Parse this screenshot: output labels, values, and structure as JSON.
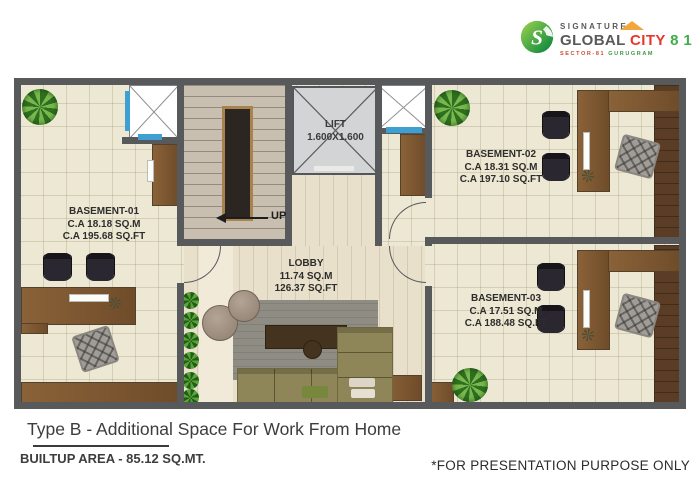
{
  "logo": {
    "signature": "SIGNATURE",
    "global": "GLOBAL ",
    "city": "CITY",
    "number": " 8 1",
    "tagline_sector": "SECTOR-81 ",
    "tagline_city": "GURUGRAM",
    "colors": {
      "gray": "#58595b",
      "red": "#e6392e",
      "green": "#3fae49",
      "orange": "#f2a63b",
      "leaf_light": "#9ed34f",
      "leaf_dark": "#00813d"
    }
  },
  "plan": {
    "rooms": {
      "basement01": {
        "name": "BASEMENT-01",
        "sqm": "C.A 18.18 SQ.M",
        "sqft": "C.A 195.68 SQ.FT"
      },
      "basement02": {
        "name": "BASEMENT-02",
        "sqm": "C.A 18.31 SQ.M",
        "sqft": "C.A 197.10 SQ.FT"
      },
      "basement03": {
        "name": "BASEMENT-03",
        "sqm": "C.A 17.51 SQ.M",
        "sqft": "C.A 188.48 SQ.FT"
      },
      "lobby": {
        "name": "LOBBY",
        "sqm": "11.74 SQ.M",
        "sqft": "126.37 SQ.FT"
      }
    },
    "lift": {
      "name": "LIFT",
      "size": "1.600X1.600"
    },
    "stairs": {
      "up_label": "UP"
    },
    "colors": {
      "wall": "#58595b",
      "floor_tile": "#ece8d4",
      "floor_wood": "#e9e0cc",
      "desk_brown": "#7d5a36",
      "lift_fill": "#d2d4d6",
      "shaft_accent_blue": "#3f9fd0",
      "sofa_olive": "#8e8558"
    }
  },
  "footer": {
    "title": "Type B - Additional Space For Work From Home",
    "builtup": "BUILTUP AREA - 85.12 SQ.MT.",
    "disclaimer": "*FOR PRESENTATION PURPOSE ONLY"
  }
}
